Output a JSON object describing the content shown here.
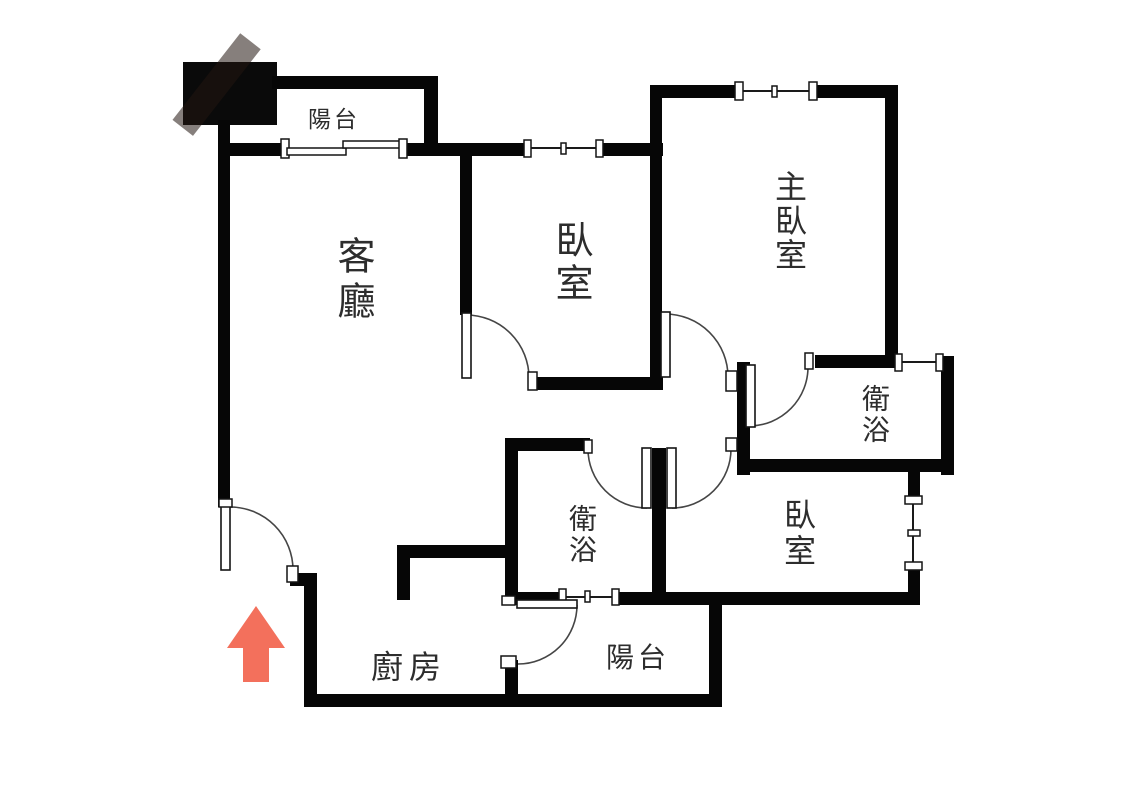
{
  "plan": {
    "type": "apartment-floor-plan",
    "rooms": [
      {
        "id": "balcony-top",
        "label": "陽台"
      },
      {
        "id": "living-room",
        "label": "客廳"
      },
      {
        "id": "bedroom-top",
        "label": "臥室"
      },
      {
        "id": "master-bedroom",
        "label": "主臥室"
      },
      {
        "id": "bathroom-upper",
        "label": "衛浴"
      },
      {
        "id": "bathroom-middle",
        "label": "衛浴"
      },
      {
        "id": "bedroom-lower",
        "label": "臥室"
      },
      {
        "id": "kitchen",
        "label": "廚房"
      },
      {
        "id": "balcony-bottom",
        "label": "陽台"
      }
    ],
    "annotations": {
      "entrance_arrow": {
        "direction": "up",
        "meaning": "entrance"
      },
      "watermark_block": {
        "shape": "black-square",
        "position": "top-left"
      }
    },
    "colors": {
      "wall": "#060606",
      "background": "#ffffff",
      "arrow": "#f3705c",
      "label_text": "#2d2d2d"
    }
  }
}
